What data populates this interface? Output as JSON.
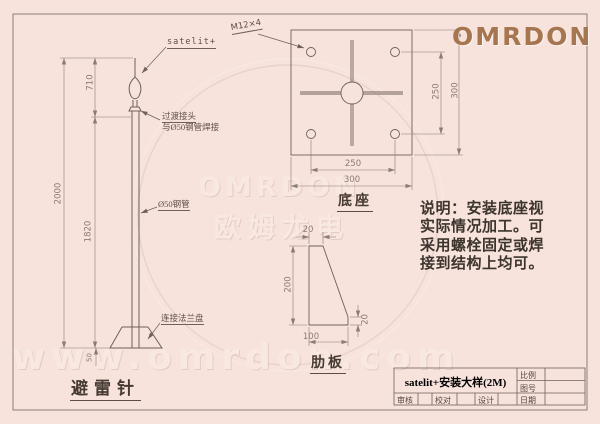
{
  "colors": {
    "background": "#f7e2dc",
    "line": "#6f6159",
    "dimension": "#8d7c74",
    "logo": "#a5764f"
  },
  "logo": {
    "text": "OMRDON"
  },
  "watermark": {
    "brand": "OMRDON",
    "brand_cn": "欧姆龙电",
    "url": "www.omrdon.com"
  },
  "rod": {
    "title": "避雷针",
    "tip_label": "satelit+",
    "joint_label_line1": "过渡接头",
    "joint_label_line2": "与Ø50钢管焊接",
    "pipe_label": "Ø50钢管",
    "flange_label": "连接法兰盘",
    "dim_total": "2000",
    "dim_top": "710",
    "dim_pipe": "1820",
    "dim_flange": "50"
  },
  "base_plate": {
    "title": "底座",
    "bolt_label": "M12×4",
    "dim_bottom_inner": "250",
    "dim_bottom_outer": "300",
    "dim_right_inner": "250",
    "dim_right_outer": "300"
  },
  "rib_plate": {
    "title": "肋板",
    "dim_top": "20",
    "dim_left": "200",
    "dim_bottom": "100",
    "dim_right": "20"
  },
  "note": {
    "line1": "说明：安装底座视",
    "line2": "实际情况加工。可",
    "line3": "采用螺栓固定或焊",
    "line4": "接到结构上均可。"
  },
  "title_block": {
    "title": "satelit+安装大样(2M)",
    "scale_label": "比例",
    "drawing_no_label": "图号",
    "date_label": "日期",
    "review_label": "审核",
    "proof_label": "校对",
    "design_label": "设计"
  }
}
